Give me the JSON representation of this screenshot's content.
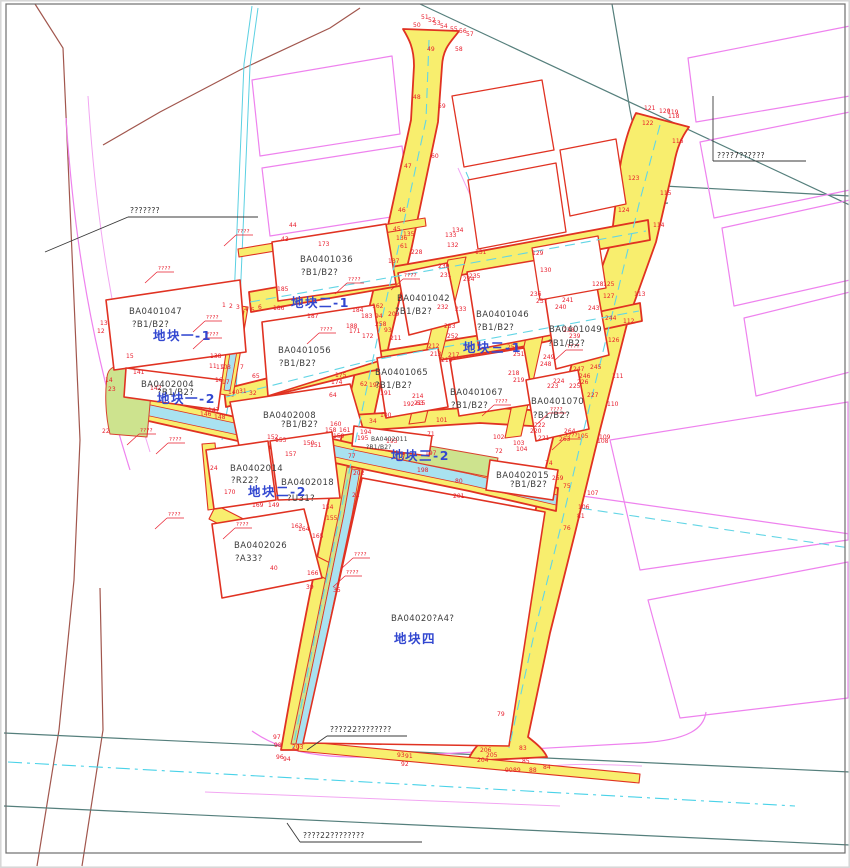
{
  "title": "land-use planning parcel map",
  "colors": {
    "road_fill": "#f8ee6e",
    "road_border": "#e03222",
    "parcel_border": "#e03222",
    "block_label": "#3247d0",
    "point_number": "#e81d2c",
    "canal": "#a9e2f0",
    "greenbelt": "#cde38e",
    "surrounding": "#ee82ee"
  },
  "parcels": [
    {
      "id": "BA0401036",
      "use": "?B1/B2?",
      "x1": 300,
      "y1": 262,
      "x2": 301,
      "y2": 275,
      "small": false
    },
    {
      "id": "BA0401047",
      "use": "?B1/B2?",
      "x1": 129,
      "y1": 314,
      "x2": 132,
      "y2": 327,
      "small": false
    },
    {
      "id": "BA0401042",
      "use": "?B1/B2?",
      "x1": 397,
      "y1": 301,
      "x2": 395,
      "y2": 314,
      "small": false
    },
    {
      "id": "BA0401046",
      "use": "?B1/B2?",
      "x1": 476,
      "y1": 317,
      "x2": 477,
      "y2": 330,
      "small": false
    },
    {
      "id": "BA0401049",
      "use": "?B1/B2?",
      "x1": 549,
      "y1": 332,
      "x2": 548,
      "y2": 346,
      "small": false
    },
    {
      "id": "BA0401056",
      "use": "?B1/B2?",
      "x1": 278,
      "y1": 353,
      "x2": 279,
      "y2": 366,
      "small": false
    },
    {
      "id": "BA0401065",
      "use": "?B1/B2?",
      "x1": 375,
      "y1": 375,
      "x2": 375,
      "y2": 388,
      "small": false
    },
    {
      "id": "BA0401067",
      "use": "?B1/B2?",
      "x1": 450,
      "y1": 395,
      "x2": 451,
      "y2": 408,
      "small": false
    },
    {
      "id": "BA0401070",
      "use": "?B1/B2?",
      "x1": 531,
      "y1": 404,
      "x2": 533,
      "y2": 418,
      "small": false
    },
    {
      "id": "BA0402004",
      "use": "?B1/B2?",
      "x1": 141,
      "y1": 387,
      "x2": 157,
      "y2": 395,
      "small": false
    },
    {
      "id": "BA0402008",
      "use": "?B1/B2?",
      "x1": 263,
      "y1": 418,
      "x2": 281,
      "y2": 427,
      "small": false
    },
    {
      "id": "BA0402011",
      "use": "?B1/B2?",
      "x1": 371,
      "y1": 441,
      "x2": 366,
      "y2": 449,
      "small": true
    },
    {
      "id": "BA0402014",
      "use": "?R22?",
      "x1": 230,
      "y1": 471,
      "x2": 231,
      "y2": 483,
      "small": false
    },
    {
      "id": "BA0402018",
      "use": "?U31?",
      "x1": 281,
      "y1": 485,
      "x2": 287,
      "y2": 501,
      "small": false
    },
    {
      "id": "BA0402026",
      "use": "?A33?",
      "x1": 234,
      "y1": 548,
      "x2": 235,
      "y2": 561,
      "small": false
    },
    {
      "id": "BA0402015",
      "use": "?B1/B2?",
      "x1": 496,
      "y1": 478,
      "x2": 510,
      "y2": 487,
      "small": false
    },
    {
      "id": "BA04020?A4?",
      "use": "",
      "x1": 391,
      "y1": 621,
      "x2": 391,
      "y2": 621,
      "small": false
    }
  ],
  "blocks": [
    {
      "label": "地块一-1",
      "x": 153,
      "y": 340
    },
    {
      "label": "地块二-1",
      "x": 291,
      "y": 307
    },
    {
      "label": "地块三-1",
      "x": 463,
      "y": 352
    },
    {
      "label": "地块一-2",
      "x": 157,
      "y": 403
    },
    {
      "label": "地块二-2",
      "x": 248,
      "y": 496
    },
    {
      "label": "地块三-2",
      "x": 391,
      "y": 460
    },
    {
      "label": "地块四",
      "x": 394,
      "y": 643
    }
  ],
  "notes": [
    {
      "text": "???????",
      "x": 130,
      "y": 213,
      "u": [
        128,
        217,
        258,
        217
      ],
      "l": [
        128,
        217,
        45,
        252
      ]
    },
    {
      "text": "????7??????",
      "x": 717,
      "y": 158,
      "u": [
        713,
        161,
        806,
        161
      ],
      "l": [
        713,
        161,
        713,
        96
      ]
    },
    {
      "text": "????22????????",
      "x": 330,
      "y": 732,
      "u": [
        327,
        736,
        407,
        736
      ],
      "l": [
        327,
        736,
        307,
        750
      ]
    },
    {
      "text": "????22????????",
      "x": 303,
      "y": 838,
      "u": [
        300,
        842,
        422,
        842
      ],
      "l": [
        300,
        842,
        287,
        823
      ]
    }
  ],
  "red_marks": [
    {
      "x": 237,
      "y": 233
    },
    {
      "x": 348,
      "y": 281
    },
    {
      "x": 404,
      "y": 277
    },
    {
      "x": 206,
      "y": 319
    },
    {
      "x": 206,
      "y": 336
    },
    {
      "x": 158,
      "y": 270
    },
    {
      "x": 320,
      "y": 331
    },
    {
      "x": 140,
      "y": 432
    },
    {
      "x": 169,
      "y": 441
    },
    {
      "x": 236,
      "y": 526
    },
    {
      "x": 354,
      "y": 556
    },
    {
      "x": 346,
      "y": 574
    },
    {
      "x": 567,
      "y": 348
    },
    {
      "x": 495,
      "y": 403
    },
    {
      "x": 550,
      "y": 411
    },
    {
      "x": 565,
      "y": 437
    },
    {
      "x": 168,
      "y": 516
    }
  ],
  "point_numbers": [
    [
      "50",
      413,
      27
    ],
    [
      "51",
      421,
      19
    ],
    [
      "52",
      428,
      22
    ],
    [
      "53",
      433,
      25
    ],
    [
      "54",
      440,
      28
    ],
    [
      "55",
      450,
      31
    ],
    [
      "56",
      459,
      33
    ],
    [
      "57",
      466,
      36
    ],
    [
      "49",
      427,
      51
    ],
    [
      "58",
      455,
      51
    ],
    [
      "48",
      413,
      99
    ],
    [
      "59",
      438,
      108
    ],
    [
      "47",
      404,
      168
    ],
    [
      "60",
      431,
      158
    ],
    [
      "46",
      398,
      212
    ],
    [
      "45",
      393,
      231
    ],
    [
      "61",
      400,
      248
    ],
    [
      "44",
      289,
      227
    ],
    [
      "43",
      281,
      241
    ],
    [
      "173",
      318,
      246
    ],
    [
      "137",
      388,
      263
    ],
    [
      "136",
      396,
      240
    ],
    [
      "135",
      403,
      236
    ],
    [
      "133",
      445,
      237
    ],
    [
      "134",
      452,
      232
    ],
    [
      "132",
      447,
      247
    ],
    [
      "131",
      475,
      254
    ],
    [
      "130",
      540,
      272
    ],
    [
      "129",
      532,
      255
    ],
    [
      "230",
      438,
      268
    ],
    [
      "231",
      440,
      277
    ],
    [
      "234",
      463,
      281
    ],
    [
      "235",
      469,
      278
    ],
    [
      "228",
      411,
      254
    ],
    [
      "232",
      437,
      309
    ],
    [
      "233",
      455,
      311
    ],
    [
      "253",
      444,
      328
    ],
    [
      "252",
      447,
      338
    ],
    [
      "212",
      428,
      348
    ],
    [
      "213",
      430,
      356
    ],
    [
      "217",
      448,
      357
    ],
    [
      "216",
      441,
      362
    ],
    [
      "218",
      508,
      375
    ],
    [
      "219",
      513,
      382
    ],
    [
      "236",
      530,
      296
    ],
    [
      "237",
      536,
      303
    ],
    [
      "241",
      562,
      302
    ],
    [
      "240",
      555,
      309
    ],
    [
      "243",
      588,
      310
    ],
    [
      "244",
      605,
      320
    ],
    [
      "238",
      563,
      332
    ],
    [
      "239",
      569,
      338
    ],
    [
      "249",
      543,
      359
    ],
    [
      "248",
      540,
      366
    ],
    [
      "247",
      573,
      371
    ],
    [
      "245",
      590,
      369
    ],
    [
      "246",
      579,
      378
    ],
    [
      "225",
      569,
      388
    ],
    [
      "226",
      577,
      384
    ],
    [
      "227",
      587,
      397
    ],
    [
      "224",
      553,
      383
    ],
    [
      "223",
      547,
      388
    ],
    [
      "250",
      507,
      349
    ],
    [
      "251",
      513,
      356
    ],
    [
      "222",
      534,
      427
    ],
    [
      "221",
      538,
      440
    ],
    [
      "220",
      530,
      433
    ],
    [
      "264",
      564,
      433
    ],
    [
      "263",
      559,
      441
    ],
    [
      "110",
      607,
      406
    ],
    [
      "111",
      612,
      378
    ],
    [
      "112",
      623,
      323
    ],
    [
      "113",
      634,
      296
    ],
    [
      "127",
      603,
      298
    ],
    [
      "128",
      592,
      286
    ],
    [
      "126",
      608,
      342
    ],
    [
      "121",
      644,
      110
    ],
    [
      "120",
      659,
      113
    ],
    [
      "119",
      667,
      114
    ],
    [
      "118",
      668,
      118
    ],
    [
      "122",
      642,
      125
    ],
    [
      "116",
      672,
      143
    ],
    [
      "123",
      628,
      180
    ],
    [
      "115",
      660,
      195
    ],
    [
      "124",
      618,
      212
    ],
    [
      "114",
      653,
      227
    ],
    [
      "125",
      603,
      286
    ],
    [
      "185",
      277,
      291
    ],
    [
      "186",
      273,
      310
    ],
    [
      "187",
      307,
      318
    ],
    [
      "184",
      352,
      312
    ],
    [
      "183",
      361,
      318
    ],
    [
      "188",
      346,
      328
    ],
    [
      "171",
      349,
      333
    ],
    [
      "172",
      362,
      338
    ],
    [
      "162",
      372,
      308
    ],
    [
      "94",
      375,
      318
    ],
    [
      "209",
      388,
      316
    ],
    [
      "93",
      384,
      332
    ],
    [
      "211",
      390,
      340
    ],
    [
      "258",
      375,
      326
    ],
    [
      "175",
      335,
      377
    ],
    [
      "174",
      331,
      384
    ],
    [
      "64",
      329,
      397
    ],
    [
      "65",
      252,
      378
    ],
    [
      "7",
      240,
      369
    ],
    [
      "8",
      227,
      369
    ],
    [
      "110",
      216,
      369
    ],
    [
      "11",
      209,
      368
    ],
    [
      "9",
      221,
      369
    ],
    [
      "13",
      100,
      325
    ],
    [
      "12",
      97,
      333
    ],
    [
      "15",
      126,
      358
    ],
    [
      "14",
      105,
      382
    ],
    [
      "141",
      133,
      374
    ],
    [
      "142",
      150,
      390
    ],
    [
      "23",
      108,
      391
    ],
    [
      "22",
      102,
      433
    ],
    [
      "1",
      222,
      307
    ],
    [
      "2",
      229,
      308
    ],
    [
      "3",
      236,
      309
    ],
    [
      "4",
      244,
      311
    ],
    [
      "5",
      251,
      312
    ],
    [
      "6",
      258,
      309
    ],
    [
      "138",
      210,
      358
    ],
    [
      "16",
      215,
      382
    ],
    [
      "17",
      222,
      384
    ],
    [
      "146",
      200,
      416
    ],
    [
      "147",
      208,
      412
    ],
    [
      "148",
      214,
      419
    ],
    [
      "140",
      228,
      394
    ],
    [
      "31",
      239,
      393
    ],
    [
      "32",
      249,
      395
    ],
    [
      "24",
      210,
      470
    ],
    [
      "170",
      224,
      494
    ],
    [
      "169",
      252,
      507
    ],
    [
      "149",
      268,
      507
    ],
    [
      "153",
      275,
      442
    ],
    [
      "152",
      267,
      439
    ],
    [
      "157",
      285,
      456
    ],
    [
      "158",
      325,
      432
    ],
    [
      "160",
      330,
      426
    ],
    [
      "161",
      339,
      432
    ],
    [
      "159",
      333,
      438
    ],
    [
      "150",
      303,
      445
    ],
    [
      "151",
      310,
      447
    ],
    [
      "154",
      322,
      509
    ],
    [
      "155",
      326,
      520
    ],
    [
      "164",
      298,
      531
    ],
    [
      "163",
      291,
      528
    ],
    [
      "165",
      312,
      538
    ],
    [
      "166",
      307,
      575
    ],
    [
      "39",
      306,
      589
    ],
    [
      "35",
      333,
      592
    ],
    [
      "40",
      270,
      570
    ],
    [
      "21",
      352,
      497
    ],
    [
      "62",
      360,
      386
    ],
    [
      "190",
      369,
      387
    ],
    [
      "191",
      380,
      395
    ],
    [
      "63",
      416,
      405
    ],
    [
      "214",
      412,
      398
    ],
    [
      "215",
      414,
      405
    ],
    [
      "192",
      403,
      406
    ],
    [
      "34",
      369,
      423
    ],
    [
      "100",
      380,
      417
    ],
    [
      "101",
      436,
      422
    ],
    [
      "193",
      386,
      443
    ],
    [
      "194",
      360,
      434
    ],
    [
      "195",
      357,
      440
    ],
    [
      "197",
      425,
      455
    ],
    [
      "198",
      417,
      472
    ],
    [
      "71",
      427,
      436
    ],
    [
      "72",
      495,
      453
    ],
    [
      "74",
      545,
      465
    ],
    [
      "75",
      563,
      488
    ],
    [
      "80",
      455,
      483
    ],
    [
      "201",
      453,
      498
    ],
    [
      "202",
      353,
      475
    ],
    [
      "77",
      348,
      458
    ],
    [
      "259",
      552,
      480
    ],
    [
      "102",
      493,
      439
    ],
    [
      "103",
      513,
      445
    ],
    [
      "104",
      516,
      451
    ],
    [
      "105",
      577,
      438
    ],
    [
      "109",
      599,
      439
    ],
    [
      "108",
      597,
      443
    ],
    [
      "107",
      587,
      495
    ],
    [
      "106",
      578,
      509
    ],
    [
      "81",
      577,
      518
    ],
    [
      "76",
      563,
      530
    ],
    [
      "79",
      497,
      716
    ],
    [
      "97",
      273,
      739
    ],
    [
      "98",
      274,
      747
    ],
    [
      "203",
      292,
      749
    ],
    [
      "96",
      276,
      759
    ],
    [
      "94",
      283,
      761
    ],
    [
      "93",
      397,
      757
    ],
    [
      "91",
      405,
      758
    ],
    [
      "92",
      401,
      766
    ],
    [
      "83",
      519,
      750
    ],
    [
      "206",
      480,
      752
    ],
    [
      "204",
      477,
      762
    ],
    [
      "205",
      486,
      757
    ],
    [
      "90",
      505,
      772
    ],
    [
      "89",
      513,
      772
    ],
    [
      "88",
      529,
      772
    ],
    [
      "84",
      543,
      769
    ],
    [
      "85",
      522,
      763
    ]
  ]
}
